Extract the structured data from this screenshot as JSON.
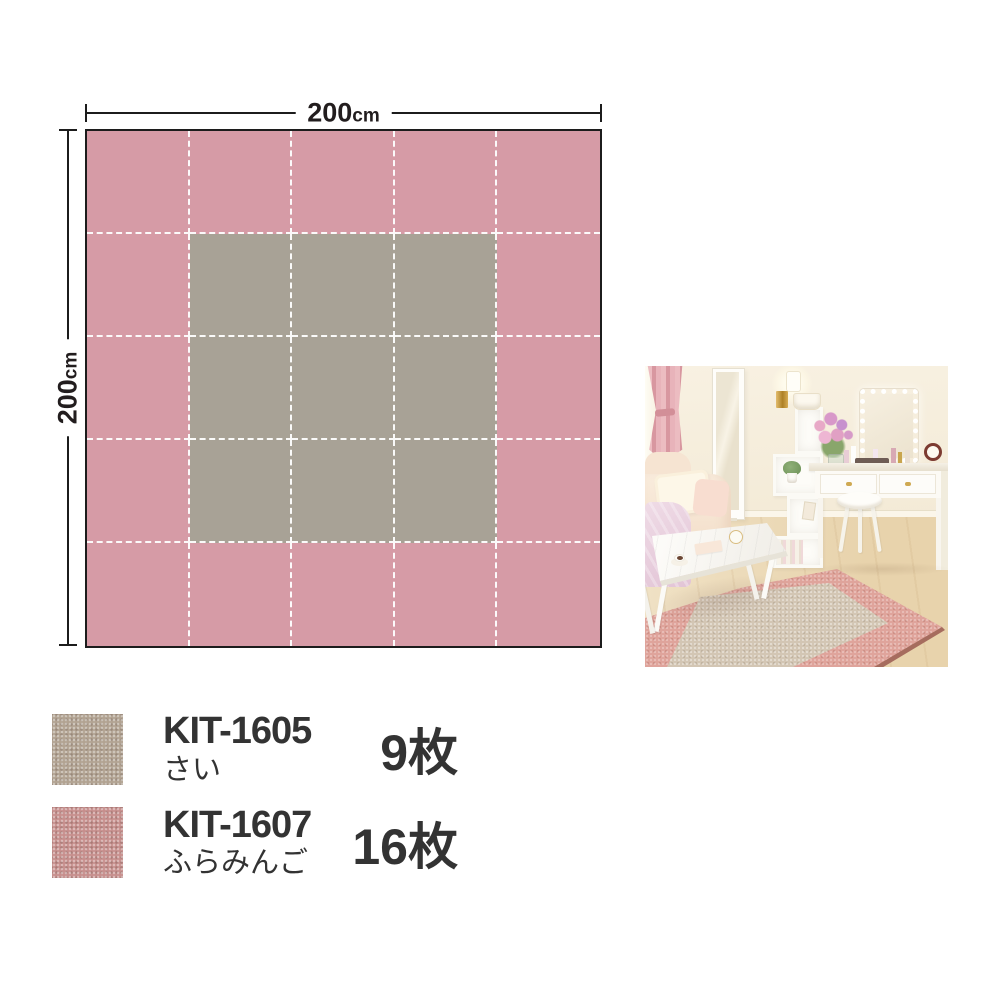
{
  "diagram": {
    "top_dimension": {
      "value": "200",
      "unit": "cm"
    },
    "left_dimension": {
      "value": "200",
      "unit": "cm"
    },
    "grid": {
      "rows": 5,
      "cols": 5,
      "outer_color": "#d69ba6",
      "inner_color": "#a8a296",
      "inner_row_start": 1,
      "inner_row_end": 3,
      "inner_col_start": 1,
      "inner_col_end": 3,
      "line_color": "#ffffff",
      "border_color": "#1c1c1c"
    }
  },
  "legend": {
    "items": [
      {
        "code": "KIT-1605",
        "name": "さい",
        "count": "9枚",
        "swatch_color": "#b2a392"
      },
      {
        "code": "KIT-1607",
        "name": "ふらみんご",
        "count": "16枚",
        "swatch_color": "#c78f8d"
      }
    ]
  },
  "photo": {
    "rug_outer_color": "#dfa49b",
    "rug_inner_color": "#d3c6b4"
  }
}
